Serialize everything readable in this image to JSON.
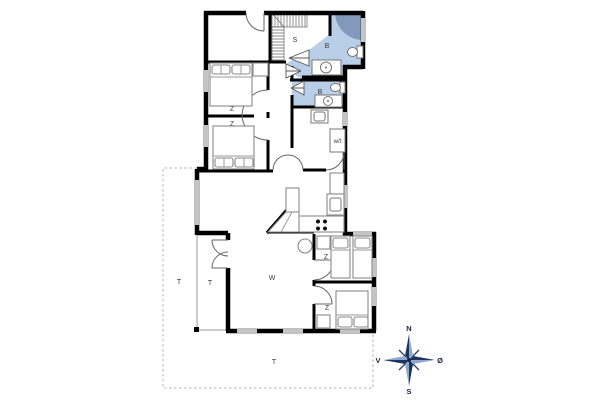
{
  "rooms": {
    "sauna": "S",
    "bath_top": "B",
    "bath_middle": "B",
    "bedroom_nw": "Z",
    "bedroom_w": "Z",
    "bedroom_e": "Z",
    "bedroom_se": "Z",
    "living": "W",
    "utility": "w/t",
    "terrace_west": "T",
    "terrace_porch": "T",
    "terrace_south": "T"
  },
  "compass": {
    "north": "N",
    "south": "S",
    "west": "V",
    "east": "Ø"
  },
  "colors": {
    "wall": "#000000",
    "bath_fill": "#b9cfe8",
    "shower_fill": "#8298bd",
    "window": "#c4c4c4",
    "compass_dark": "#1d3461",
    "compass_light": "#93a7cb",
    "terrace_outline": "#b3b3b3"
  }
}
